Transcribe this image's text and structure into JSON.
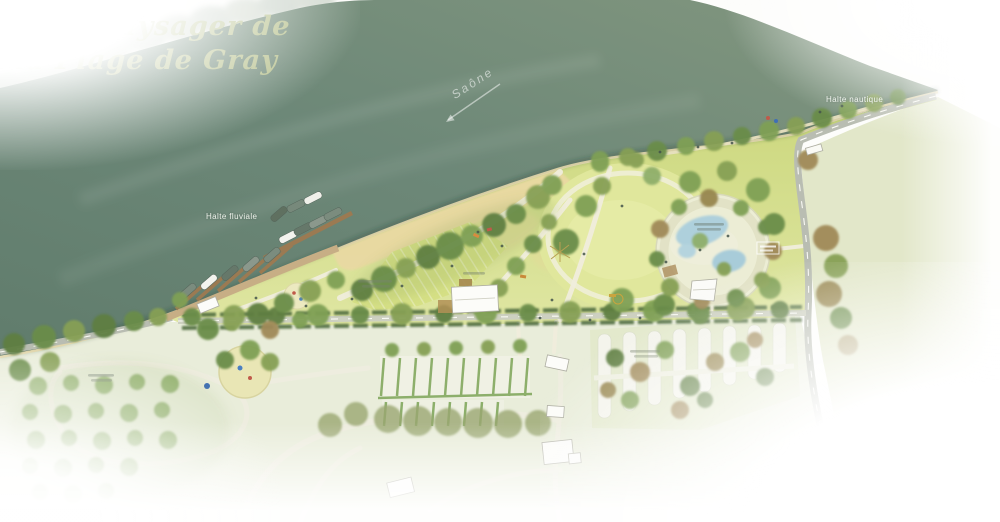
{
  "title": {
    "line1": "Parc paysager de",
    "line2": "la Plage de Gray"
  },
  "river": {
    "name": "Saône"
  },
  "labels": {
    "halte_fluviale": "Halte fluviale",
    "halte_nautique": "Halte nautique"
  },
  "colors": {
    "river": "#6d8878",
    "park_lawn": "#cdd87e",
    "pale_fields": "#e8ecd9",
    "sand": "#e8d8a2",
    "road": "#b9bdb2",
    "pond": "#afd0dc",
    "hedge": "#4e6b3c",
    "title_text": "#b6c08c"
  }
}
